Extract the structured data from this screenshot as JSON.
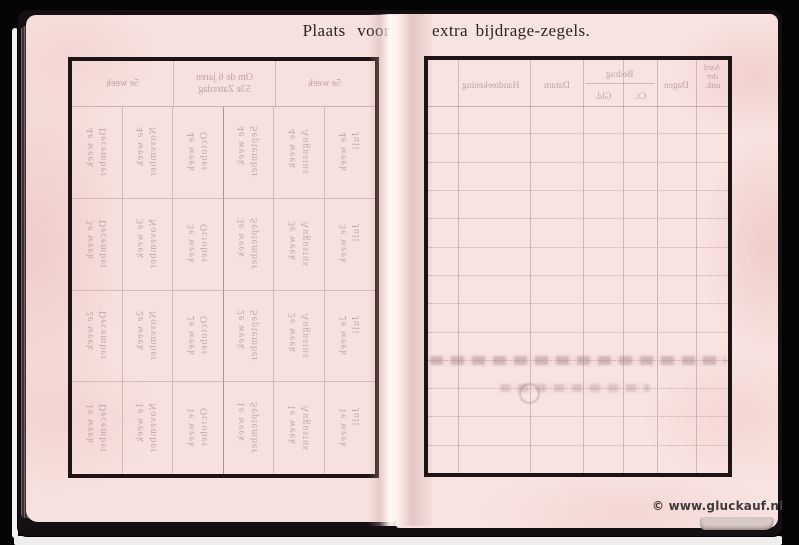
{
  "titles": {
    "left": "Plaats voor",
    "right": "extra bijdrage-zegels."
  },
  "left_page": {
    "bleed_table": {
      "header_left": "5e week",
      "header_middle": "Om de 6 jaren\n53e Zaterdag",
      "header_right": "5e week",
      "months": [
        "December",
        "November",
        "October",
        "September",
        "Augustus",
        "Juli"
      ],
      "week_rows": [
        "4e week",
        "3e week",
        "2e week",
        "1e week"
      ]
    }
  },
  "right_page": {
    "bleed_header": {
      "handteekening": "Handteekening",
      "datum": "Datum",
      "bedrag": "Bedrag",
      "gld": "Gld.",
      "ct": "Ct.",
      "dagen": "Dagen",
      "aard": "Aard\nder\nuitk."
    }
  },
  "watermark": "© www.gluckauf.nl",
  "colors": {
    "page_pink": "#f7e1de",
    "table_border": "#1e1316",
    "bleed_ink": "#986e7a",
    "title_ink": "#2b2326",
    "cover": "#140f13",
    "watermark_ink": "#3f3b3c"
  }
}
